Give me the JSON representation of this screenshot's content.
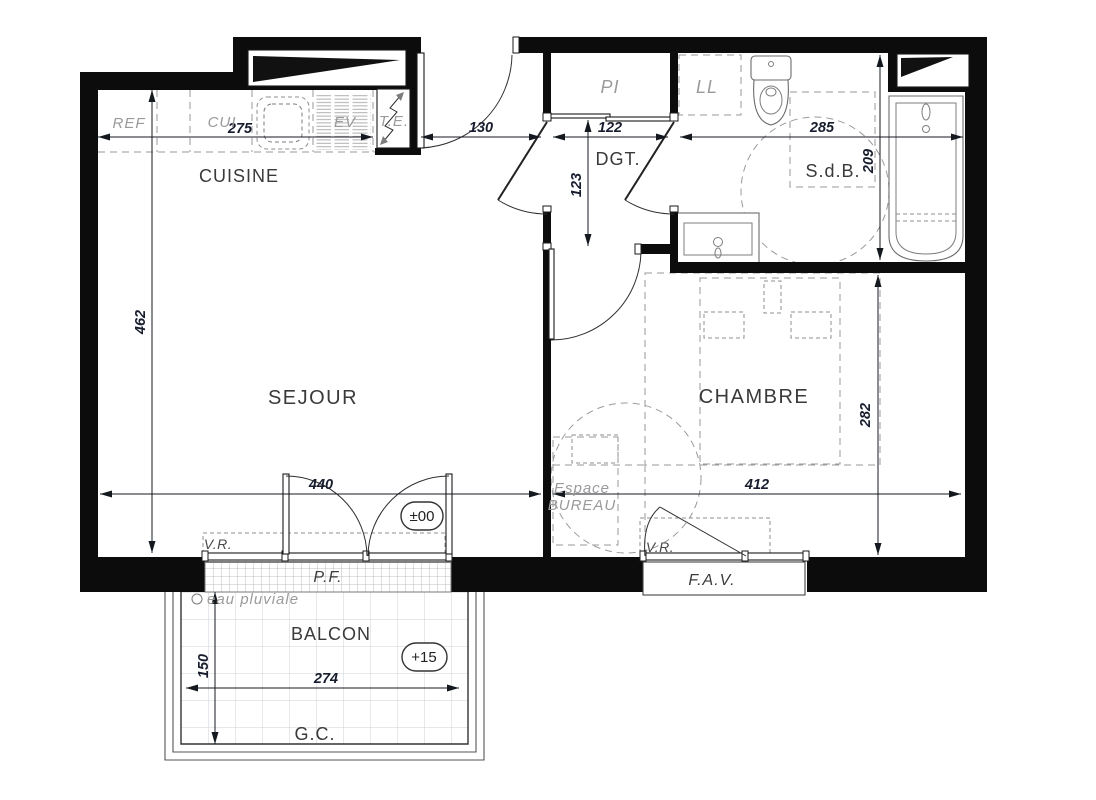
{
  "plan": {
    "rooms": {
      "kitchen": "CUISINE",
      "living": "SEJOUR",
      "bedroom": "CHAMBRE",
      "hall": "DGT.",
      "bathroom": "S.d.B.",
      "balcony": "BALCON"
    },
    "fixtures": {
      "fridge": "REF",
      "cooker": "CUI",
      "sink_unit": "EV",
      "electrical_panel": "T.E.",
      "closet": "PI",
      "washing_machine": "LL",
      "office_line1": "Espace",
      "office_line2": "BUREAU"
    },
    "openings": {
      "living_window": "P.F.",
      "bedroom_window": "F.A.V.",
      "roller_shutter_living": "V.R.",
      "roller_shutter_bedroom": "V.R."
    },
    "notes": {
      "rainwater": "eau pluviale",
      "gutter": "G.C."
    },
    "levels": {
      "living": "±00",
      "balcony": "+15"
    },
    "dims": {
      "kitchen_counter": "275",
      "entry": "130",
      "hall_width": "122",
      "bath_width": "285",
      "living_height": "462",
      "living_width": "440",
      "bedroom_width": "412",
      "hall_depth": "123",
      "bath_depth": "209",
      "bedroom_depth": "282",
      "balcony_depth": "150",
      "balcony_width": "274"
    },
    "colors": {
      "wall": "#0c0c0c",
      "dimension_text": "#181d2e",
      "muted_label": "#9a9a9a",
      "room_label": "#3a3a3a"
    }
  }
}
